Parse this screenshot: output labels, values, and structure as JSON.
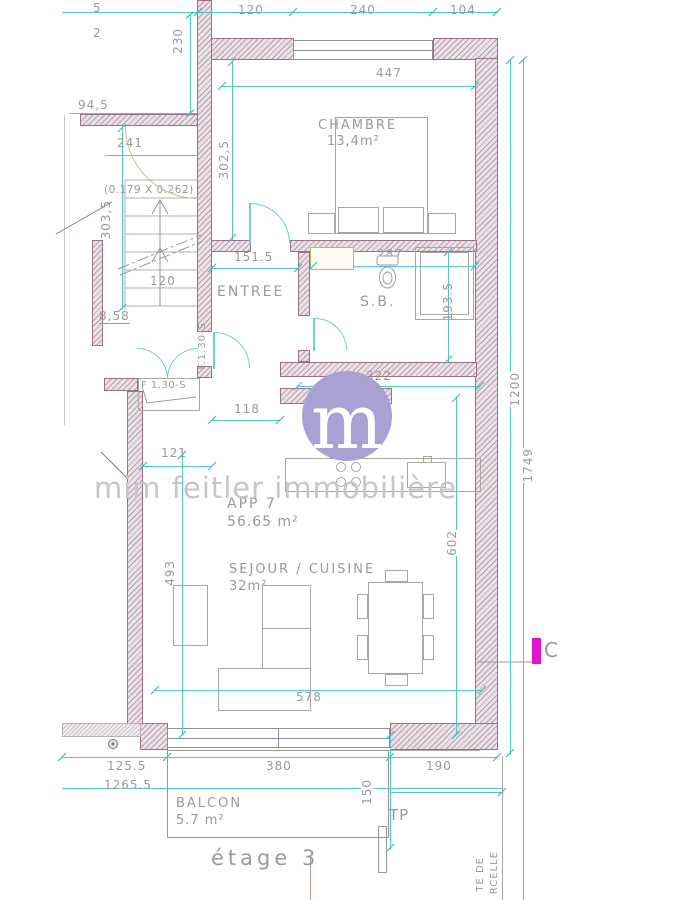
{
  "document": {
    "floor_label": "étage 3"
  },
  "branding": {
    "watermark": "mim feitler immobilière",
    "logo_letter": "m",
    "logo_color": "#a8a1d1"
  },
  "apartment": {
    "name": "APP 7",
    "area": "56.65 m²"
  },
  "rooms": {
    "chambre": {
      "name": "CHAMBRE",
      "area": "13,4m²"
    },
    "entree": {
      "name": "ENTREE"
    },
    "sb": {
      "name": "S.B."
    },
    "sejour": {
      "name": "SEJOUR / CUISINE",
      "area": "32m²"
    },
    "balcon": {
      "name": "BALCON",
      "area": "5.7 m²"
    }
  },
  "markers": {
    "section": "C",
    "tp": "TP",
    "parcel_line_1": "TE DE",
    "parcel_line_2": "RCELLE",
    "door_code_vertical": "F.1.30-S",
    "door_code_horizontal": "F 1.30-S",
    "stair_step_dims": "(0.179 X 0.262)"
  },
  "dims": {
    "top_frag_1": "5",
    "top_frag_2": "2",
    "w120": "120",
    "w240": "240",
    "w104": "104",
    "h230": "230",
    "w447": "447",
    "w94_5": "94,5",
    "w241": "241",
    "h302_5": "302,5",
    "h303_5": "303,5",
    "w151_5": "151.5",
    "w120_stair": "120",
    "w8_58": "8,58",
    "w287": "287",
    "h193_5": "193.5",
    "w322": "322",
    "w118": "118",
    "w121": "121",
    "h1200": "1200",
    "h1749": "1749",
    "h493": "493",
    "h602": "602",
    "w578": "578",
    "w125_5": "125.5",
    "w380": "380",
    "w190": "190",
    "w1265_5": "1265.5",
    "h150": "150"
  },
  "colors": {
    "dimension": "#53c6c6",
    "wall": "#9c7086",
    "text": "#9a9a9a",
    "magenta": "#e414ce"
  }
}
